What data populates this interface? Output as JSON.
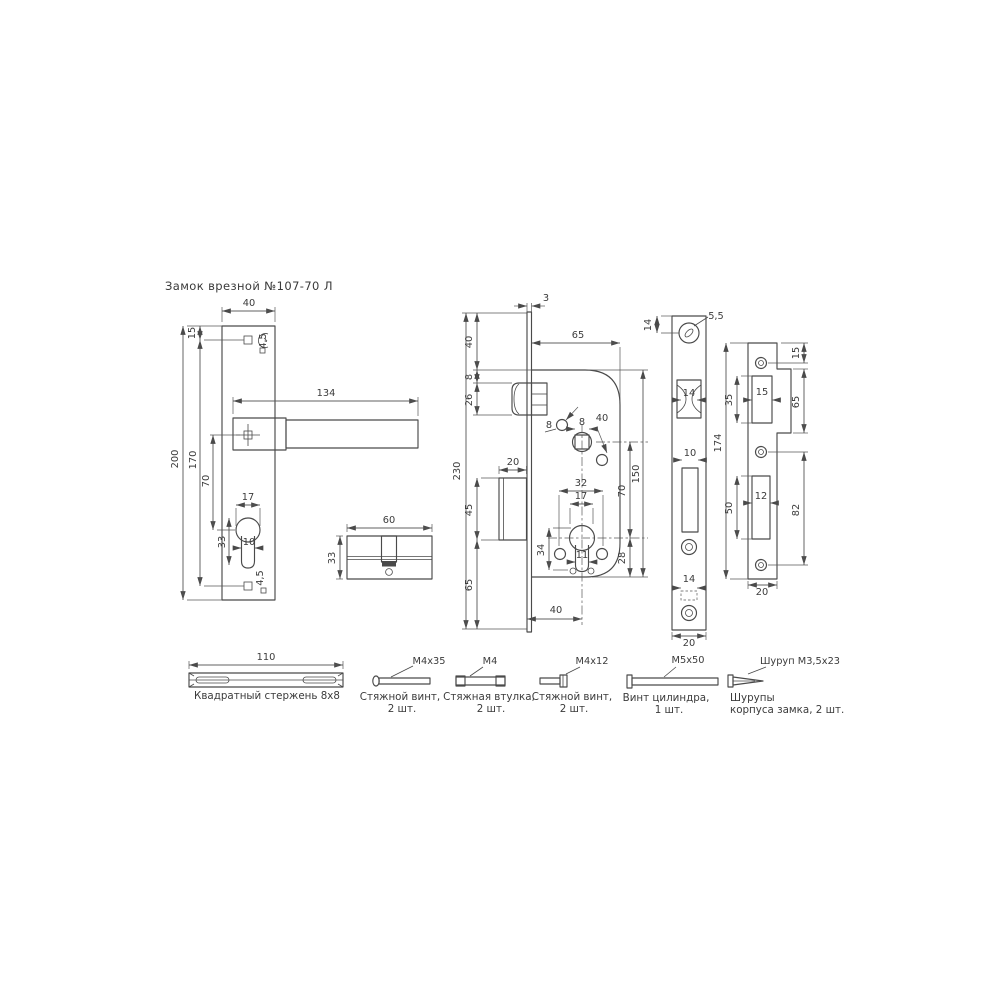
{
  "title": "Замок врезной №107-70 Л",
  "views": {
    "handle_plate": {
      "dims": {
        "width": "40",
        "top_hole_offset": "15",
        "handle_length": "134",
        "height": "200",
        "hole_span": "170",
        "handle_to_keyhole": "70",
        "keyhole_width": "17",
        "keyhole_height": "33",
        "keyhole_lobe": "10",
        "top_hole_dia": "4,5",
        "bottom_hole_dia": "4,5"
      }
    },
    "cylinder": {
      "dims": {
        "length": "60",
        "height": "33"
      }
    },
    "lock_body": {
      "dims": {
        "faceplate_thickness": "3",
        "plate_to_body": "40",
        "body_to_latch": "8",
        "latch_height": "26",
        "body_width": "65",
        "screw_hole_dia": "8",
        "spindle_size": "8",
        "screw_hole_spacing": "40",
        "faceplate_height": "230",
        "deadbolt_width": "20",
        "deadbolt_height": "45",
        "lower_screw_span": "32",
        "cylinder_dia": "17",
        "spindle_to_cylinder": "70",
        "body_height": "150",
        "cylinder_offset": "34",
        "cylinder_lobe": "11",
        "cylinder_to_bottom": "28",
        "deadbolt_to_bottom": "65",
        "backset": "40"
      }
    },
    "faceplate": {
      "dims": {
        "top_hole_offset": "14",
        "hole_dia": "5,5",
        "latch_cutout": "14",
        "bolt_cutout": "10",
        "lower_cutout": "14",
        "width": "20"
      }
    },
    "strike_plate": {
      "dims": {
        "height": "174",
        "top_hole_offset": "15",
        "latch_cutout_height": "35",
        "latch_cutout_width": "15",
        "tab_height": "65",
        "bolt_cutout_height": "50",
        "bolt_cutout_width": "12",
        "hole_span": "82",
        "width": "20"
      }
    }
  },
  "hardware": {
    "rod": {
      "length": "110",
      "caption": "Квадратный стержень 8х8"
    },
    "screw_m4x35": {
      "label": "M4x35",
      "caption1": "Стяжной винт,",
      "caption2": "2 шт."
    },
    "sleeve_m4": {
      "label": "M4",
      "caption1": "Стяжная втулка,",
      "caption2": "2 шт."
    },
    "screw_m4x12": {
      "label": "M4x12",
      "caption1": "Стяжной винт,",
      "caption2": "2 шт."
    },
    "screw_m5x50": {
      "label": "M5x50",
      "caption1": "Винт цилиндра,",
      "caption2": "1 шт."
    },
    "wood_screw": {
      "label": "Шуруп M3,5x23",
      "caption1": "Шурупы",
      "caption2": "корпуса замка, 2 шт."
    }
  },
  "colors": {
    "line": "#4a4a4a",
    "text": "#3b3b3b",
    "background": "#ffffff"
  }
}
